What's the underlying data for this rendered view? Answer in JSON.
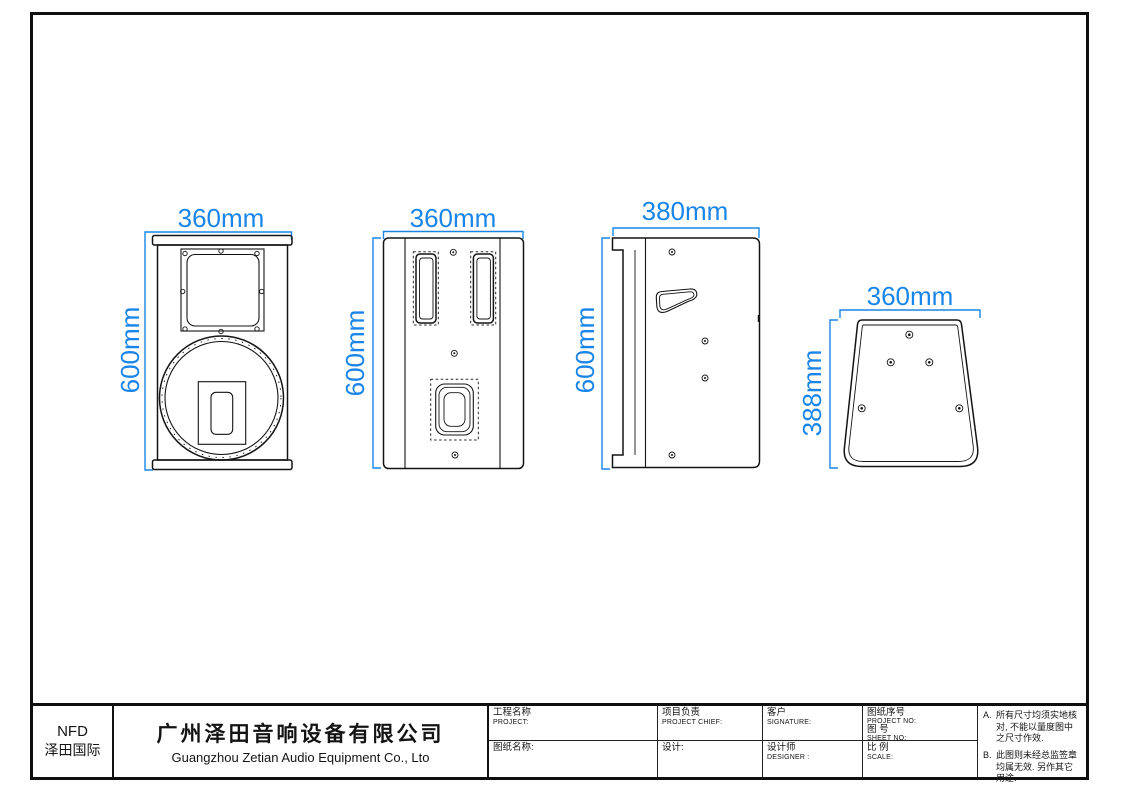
{
  "colors": {
    "dimension_blue": "#1a85e8",
    "line_black": "#141414"
  },
  "views": {
    "front": {
      "width": "360mm",
      "height": "600mm"
    },
    "rear": {
      "width": "360mm",
      "height": "600mm"
    },
    "side": {
      "width": "380mm",
      "height": "600mm"
    },
    "bottom": {
      "width": "360mm",
      "height": "388mm"
    }
  },
  "title_block": {
    "logo": {
      "brand": "NFD",
      "brand_cn": "泽田国际"
    },
    "company": {
      "name_cn": "广州泽田音响设备有限公司",
      "name_en": "Guangzhou Zetian Audio Equipment Co., Lto"
    },
    "project": {
      "label_cn": "工程名称",
      "label_en": "PROJECT:"
    },
    "drawing_name": {
      "label_cn": "图纸名称:"
    },
    "project_chief": {
      "label_cn": "项目负责",
      "label_en": "PROJECT CHIEF:"
    },
    "design": {
      "label_cn": "设计:"
    },
    "customer": {
      "label_cn": "客户",
      "label_en": "SIGNATURE:"
    },
    "designer": {
      "label_cn": "设计师",
      "label_en": "DESIGNER :"
    },
    "project_no": {
      "label_cn": "图纸序号",
      "label_en": "PROJECT NO:"
    },
    "sheet_no": {
      "label_cn": "图 号",
      "label_en": "SHEET NO:"
    },
    "scale": {
      "label_cn": "比 例",
      "label_en": "SCALE:"
    },
    "notes": [
      {
        "label": "A.",
        "text": "所有尺寸均须实地核对, 不能以量度图中之尺寸作效."
      },
      {
        "label": "B.",
        "text": "此图则未经总监签章均属无效. 另作其它用途."
      }
    ]
  }
}
